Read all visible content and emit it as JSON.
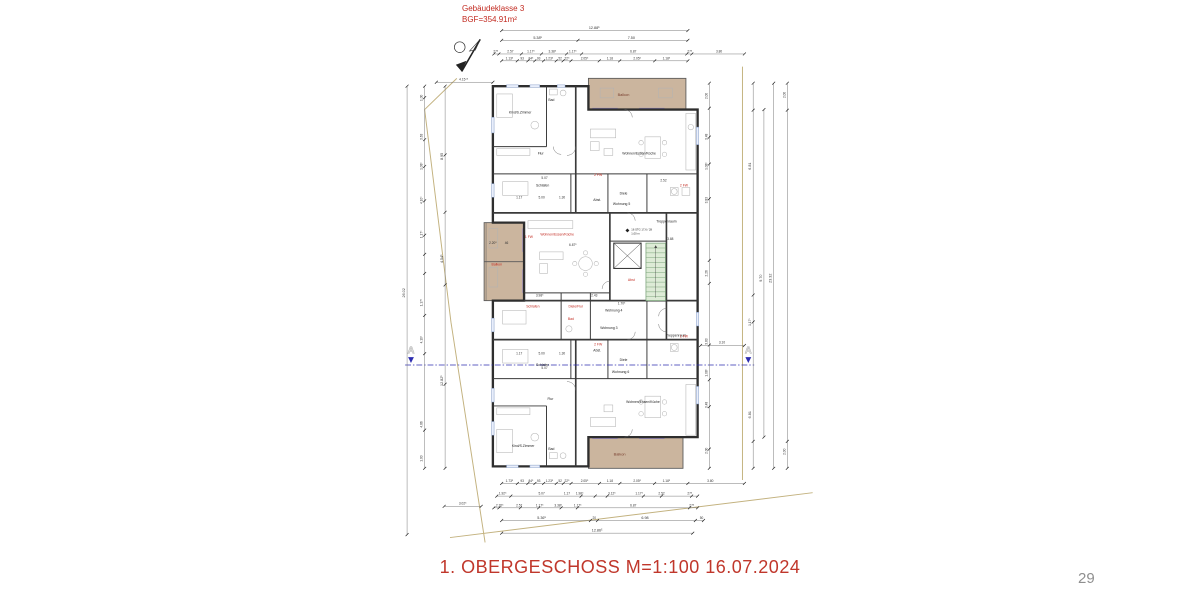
{
  "header": {
    "line1": "Gebäudeklasse 3",
    "line2": "BGF=354.91m²"
  },
  "title": "1. OBERGESCHOSS   M=1:100   16.07.2024",
  "page_number": "29",
  "colors": {
    "red_label": "#c22a20",
    "balcony_fill": "#cbb59e",
    "stair_fill": "#ddebd6",
    "stair_line": "#6f9b6f",
    "window_accent": "#988ac9",
    "boundary": "#c3b27f",
    "section_line": "#2d2db0"
  },
  "section_label": "A",
  "stair_note": {
    "line1": "16 STG 17,6 / 28",
    "line2": "1,00 m"
  },
  "rooms": {
    "kind1": "Kind/S.Zimmer",
    "bad1": "Bad",
    "flur1": "Flur",
    "wek1": "Wohnen/Essen/Küche",
    "balkon1": "Balkon",
    "schlafen1": "Schlafen",
    "abst1": "Abst.",
    "diele1": "Diele",
    "we5": "Wohnung 5",
    "treppe1": "Treppenraum",
    "wek2": "Wohnen/Essen/Küche",
    "schlafen2": "Schlafen",
    "dieleflur": "Diele/Flur",
    "bad2": "Bad",
    "abst2": "Abst",
    "balkon2": "Balkon",
    "we4": "Wohnung 4",
    "we3": "Wohnung 3",
    "treppe2": "Treppenraum",
    "schlafen3": "Schlafen",
    "abst3": "Abst.",
    "diele2": "Diele",
    "we6": "Wohnung 6",
    "wek3": "Wohnen/Essen/Küche",
    "flur2": "Flur",
    "kind2": "Kind/S.Zimmer",
    "bad3": "Bad",
    "balkon3": "Balkon"
  },
  "codes": [
    "1 FW",
    "2 FW",
    "2 FW",
    "2 FW",
    "1 FW"
  ],
  "d": {
    "t1": "12.88⁵",
    "t2": [
      "5.38⁵",
      "7.50"
    ],
    "t3": [
      "27⁵",
      "2.57",
      "1.17⁵",
      "3.38⁵",
      "1.17⁵",
      "6.87",
      "27⁵",
      "3.80"
    ],
    "t4": [
      "1.13⁵",
      "93",
      "84⁵",
      "93",
      "1.23⁵",
      "52",
      "22⁵",
      "2.05⁵",
      "1.18",
      "2.05⁵",
      "1.18⁵"
    ],
    "tl": "4.15⁴⁵",
    "b1": "12.86⁵",
    "b2": [
      "5.36⁵",
      "20",
      "6.98",
      "50"
    ],
    "b3": [
      "2.20⁵",
      "2.57",
      "1.17⁵",
      "3.38⁵",
      "1.17⁵",
      "6.87",
      "27⁵"
    ],
    "b4": [
      "1.92⁵",
      "5.07",
      "1.17",
      "1.98⁵",
      "3.12⁵",
      "1.17⁵",
      "2.52",
      "27⁵"
    ],
    "b5": [
      "1.73⁵",
      "93",
      "84⁵",
      "93",
      "1.23⁵",
      "52",
      "22⁵",
      "2.05⁵",
      "1.18",
      "2.05⁵",
      "1.18⁵",
      "3.80"
    ],
    "b6": "3.02⁵",
    "l1": "26.02",
    "l2": [
      "8.95",
      "4.54⁵"
    ],
    "l3": "12.82⁵",
    "l4": [
      "1.00",
      "3.63",
      "1.08⁵",
      "4.10⁵",
      "1.17⁵",
      "1.17⁵",
      "4.10⁵",
      "4.86",
      "1.00"
    ],
    "r1": [
      "2.00",
      "3.48",
      "1.08⁵",
      "3.83",
      "2.26",
      "3.83",
      "1.08⁵",
      "3.48",
      "2.00"
    ],
    "r2": [
      "6.81",
      "1.17⁵",
      "6.81"
    ],
    "r3": "9.70",
    "r4": "23.32",
    "r5": [
      "2.00",
      "2.00"
    ],
    "r6": "3.10",
    "inner": [
      "5.07",
      "1.17",
      "5.00",
      "1.30",
      "3.98⁵",
      "2.43",
      "1.70⁵",
      "6.87⁵",
      "3.88",
      "2.20⁵",
      "46",
      "2.52",
      "1.17",
      "5.00",
      "1.30",
      "5.07"
    ]
  }
}
